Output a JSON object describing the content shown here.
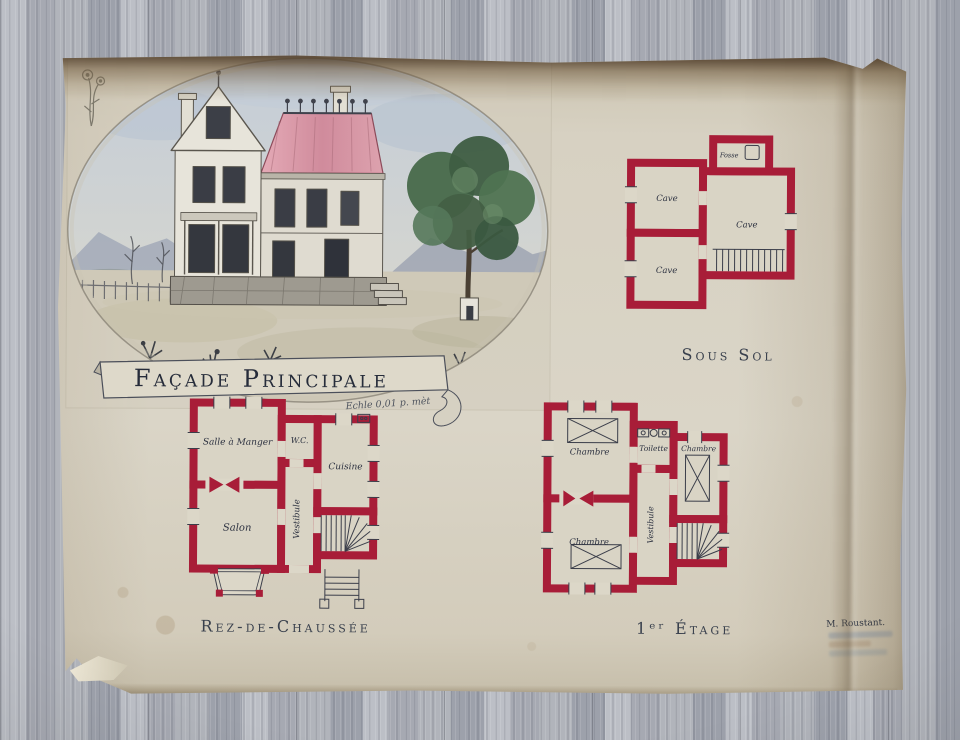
{
  "drawing": {
    "banner": {
      "title": "Façade Principale",
      "scale_note": "Echle 0,01 p. mèt"
    },
    "plans": {
      "sous_sol": {
        "caption": "Sous Sol",
        "rooms": {
          "cave1": "Cave",
          "cave2": "Cave",
          "cave3": "Cave",
          "fosse": "Fosse"
        }
      },
      "rdc": {
        "caption": "Rez-de-Chaussée",
        "rooms": {
          "salle_a_manger": "Salle à Manger",
          "wc": "W.C.",
          "cuisine": "Cuisine",
          "vestibule": "Vestibule",
          "salon": "Salon"
        }
      },
      "etage1": {
        "caption": "1ᵉʳ Étage",
        "rooms": {
          "chambre1": "Chambre",
          "toilette": "Toilette",
          "chambre2": "Chambre",
          "vestibule": "Vestibule",
          "chambre3": "Chambre"
        }
      }
    },
    "signature": "M. Roustant.",
    "colors": {
      "plan_wall_red": "#a81d38",
      "paper": "#d6d0c1",
      "ink": "#2f3340",
      "roof_pink": "#d9a3af",
      "tree_green": "#4c6e4f",
      "floor_gray": "#a7abb3"
    }
  }
}
